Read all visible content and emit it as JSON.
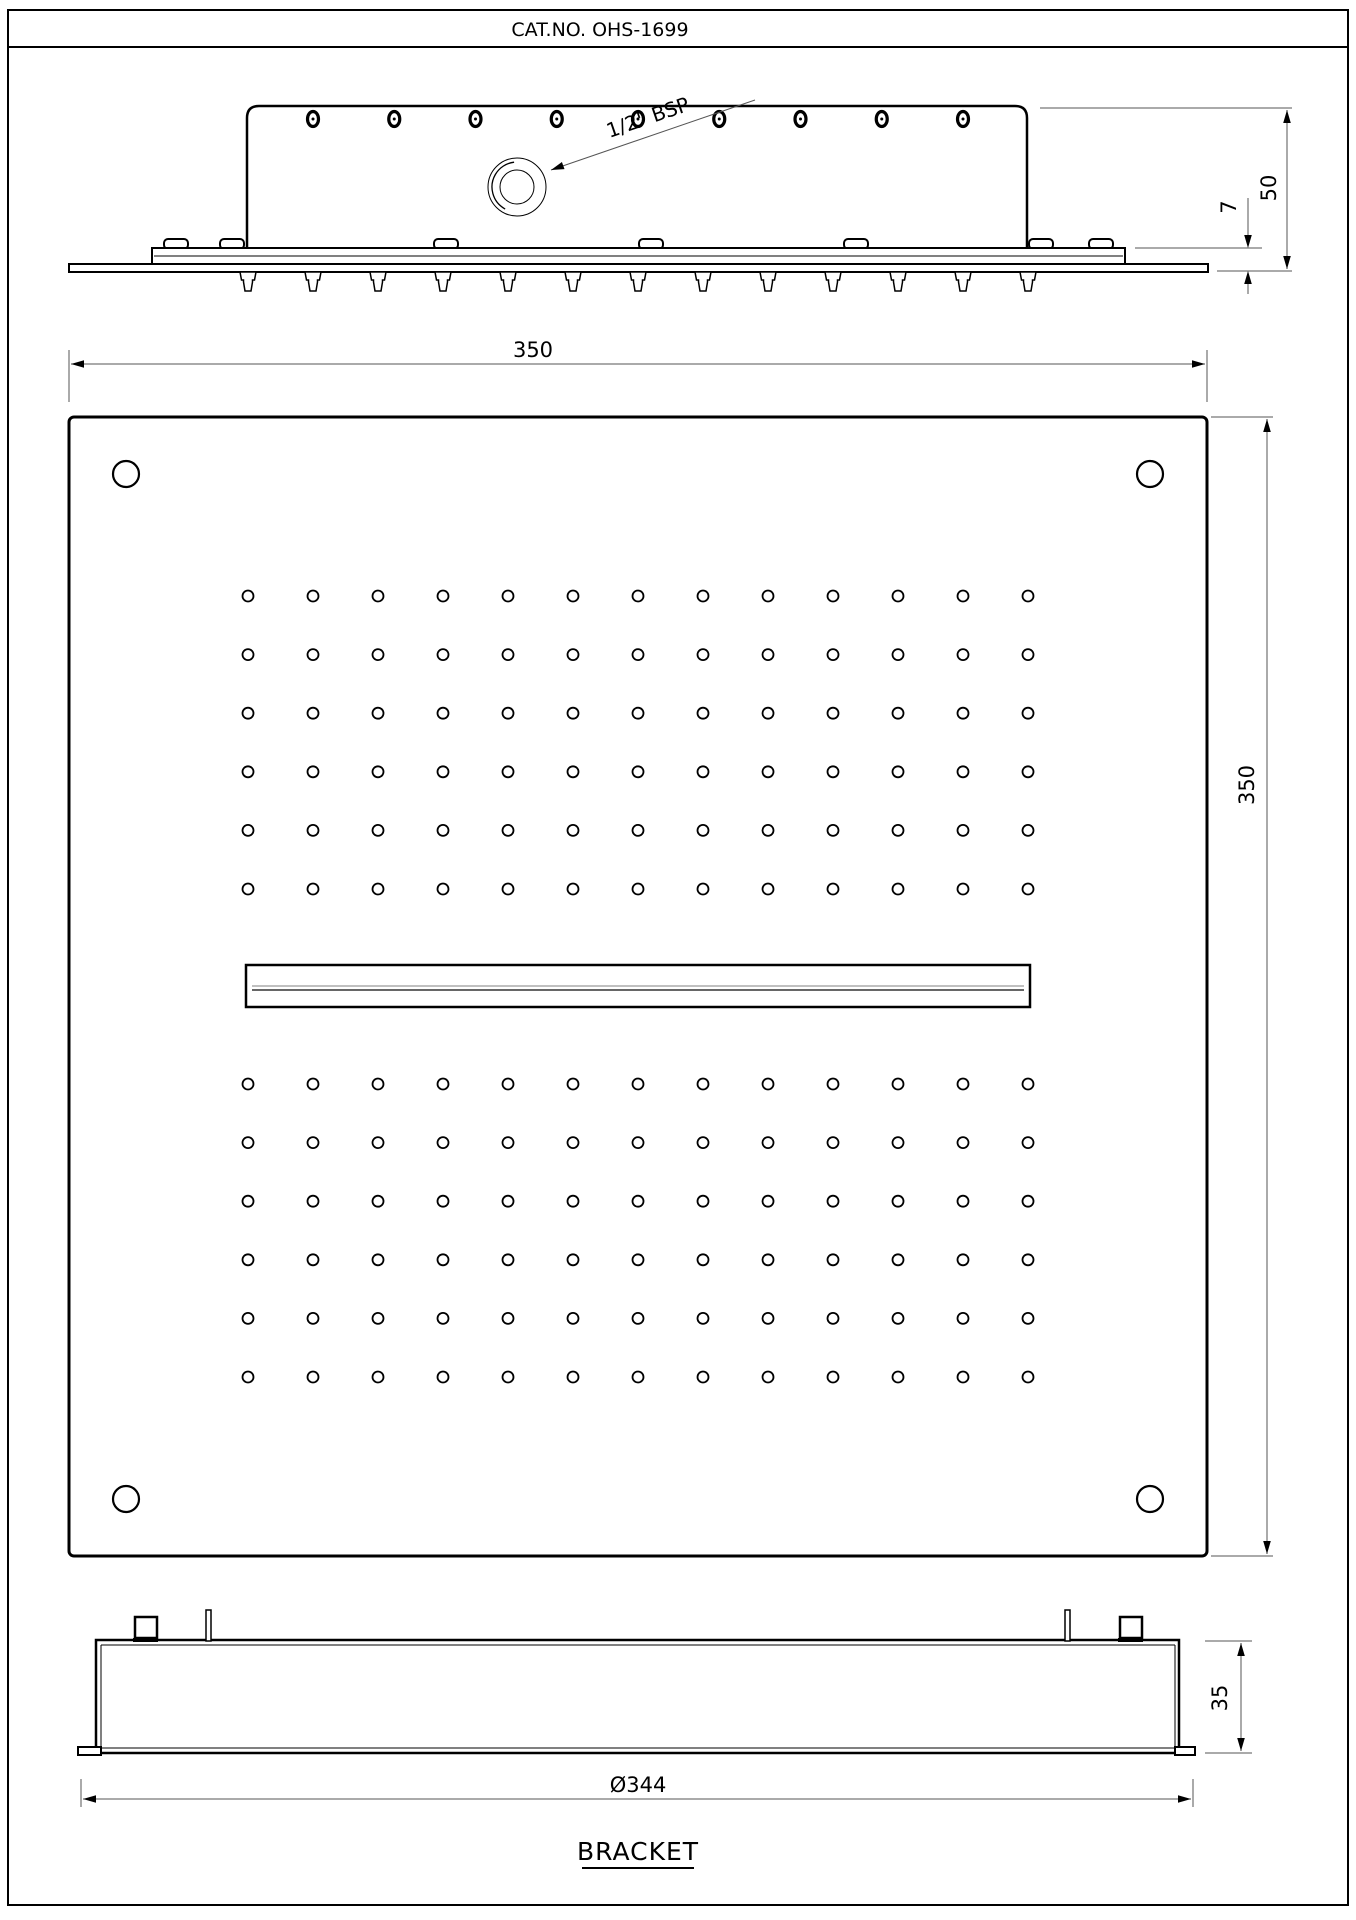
{
  "title": "CAT.NO. OHS-1699",
  "labels": {
    "bsp": "1/2\" BSP",
    "dim_width": "350",
    "dim_height": "350",
    "dim_50": "50",
    "dim_7": "7",
    "dim_35": "35",
    "dim_dia": "Ø344",
    "bracket_caption": "BRACKET"
  },
  "drawing": {
    "plate_square": {
      "x": 69,
      "y": 417,
      "w": 1138,
      "h": 1139
    },
    "nozzle_grid": {
      "cols": 13,
      "x0": 248,
      "dx": 65,
      "rows": 6,
      "hole_r": 5.5,
      "top_y0": 596,
      "bottom_y0": 1084,
      "dy": 58.6
    },
    "corner_holes": {
      "r": 13,
      "centers": [
        [
          126,
          474
        ],
        [
          1150,
          474
        ],
        [
          126,
          1499
        ],
        [
          1150,
          1499
        ]
      ]
    },
    "waterfall_slot": {
      "x": 246,
      "y": 965,
      "w": 784,
      "h": 42
    },
    "side_view": {
      "body": {
        "x1": 247,
        "y1": 106,
        "x2": 1027,
        "y2": 248
      },
      "top_slots": {
        "n": 9,
        "x0": 313,
        "dx": 81.25,
        "cy": 119,
        "rx": 5.5,
        "ry": 7.5
      },
      "inlet": {
        "cx": 517,
        "cy": 187,
        "r_outer": 29,
        "r_mid": 25,
        "r_inner": 17
      },
      "tabs": [
        176,
        232,
        446,
        651,
        856,
        1041,
        1101
      ],
      "nozzles": {
        "n": 13,
        "x0": 248,
        "dx": 65,
        "y": 272
      }
    },
    "arrows": [
      {
        "x": 71,
        "y": 364,
        "a": 180
      },
      {
        "x": 1205,
        "y": 364,
        "a": 0
      },
      {
        "x": 1267,
        "y": 419,
        "a": -90
      },
      {
        "x": 1267,
        "y": 1554,
        "a": 90
      },
      {
        "x": 1287,
        "y": 110,
        "a": -90
      },
      {
        "x": 1287,
        "y": 269,
        "a": 90
      },
      {
        "x": 1248,
        "y": 248,
        "a": 90
      },
      {
        "x": 1248,
        "y": 271,
        "a": -90
      },
      {
        "x": 1241,
        "y": 1643,
        "a": -90
      },
      {
        "x": 1241,
        "y": 1751,
        "a": 90
      },
      {
        "x": 83,
        "y": 1799,
        "a": 180
      },
      {
        "x": 1191,
        "y": 1799,
        "a": 0
      },
      {
        "x": 551,
        "y": 170,
        "a": 160
      }
    ]
  }
}
